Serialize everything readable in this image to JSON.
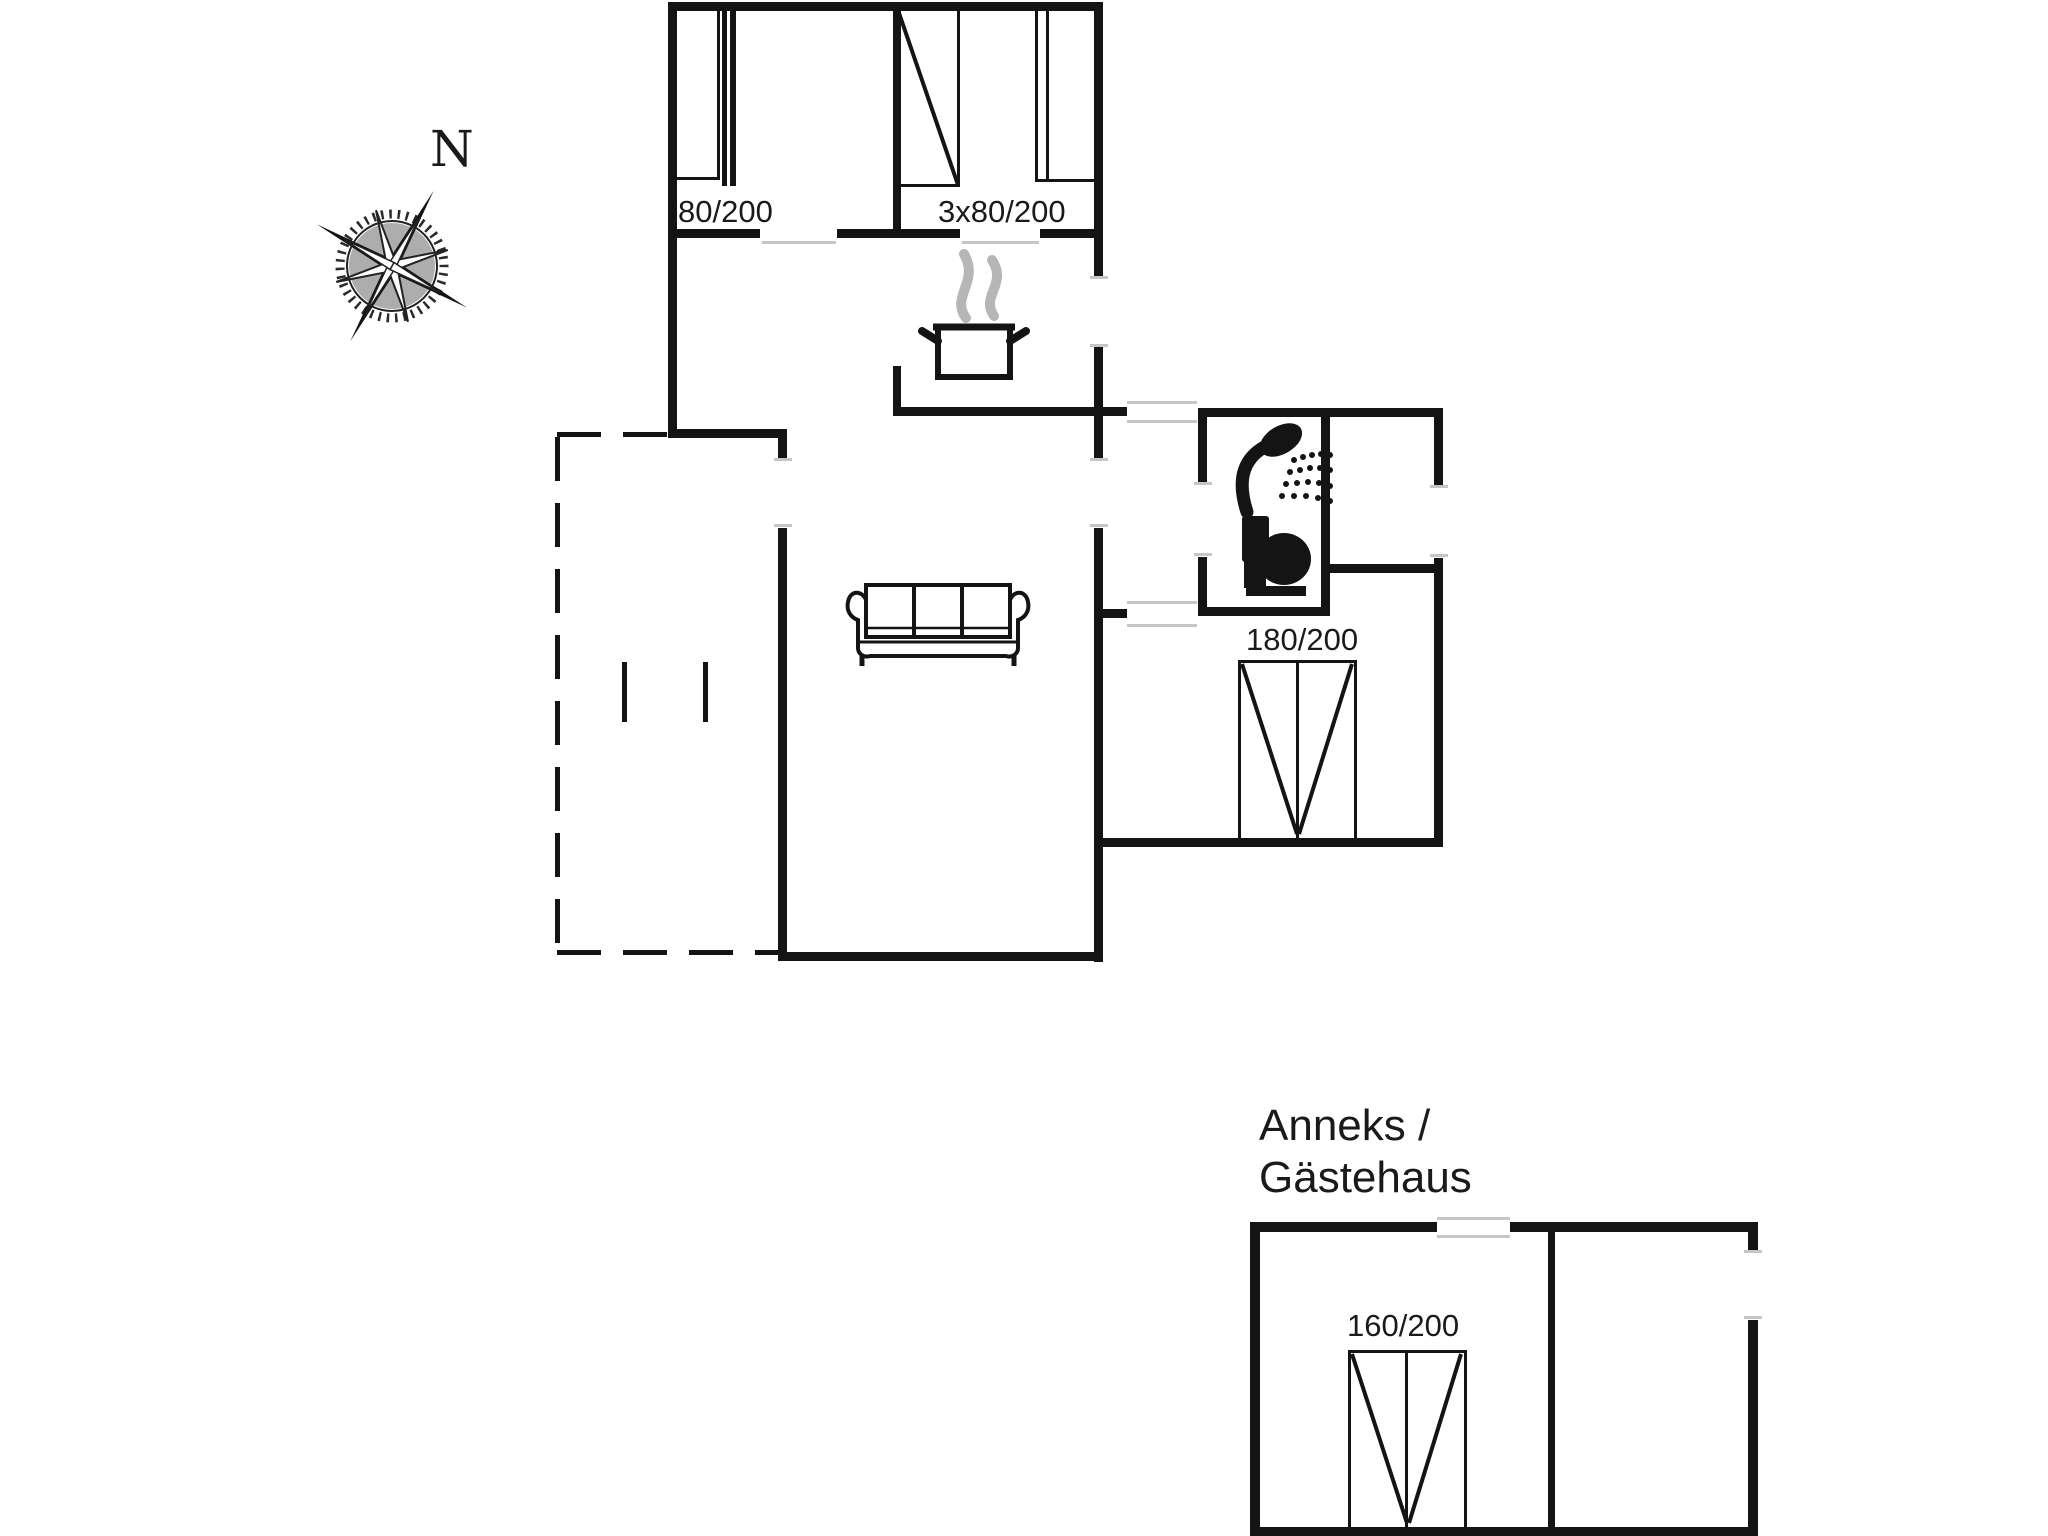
{
  "colors": {
    "wall": "#141414",
    "light": "#c6c6c6",
    "steam": "#b6b6b6",
    "text": "#1a1a1a",
    "bg": "#ffffff"
  },
  "compass": {
    "north_label": "N"
  },
  "labels": {
    "window_80": "80/200",
    "window_3x80": "3x80/200",
    "window_180": "180/200",
    "window_160": "160/200",
    "annex_line1": "Anneks /",
    "annex_line2": "Gästehaus"
  },
  "fixtures": {
    "compass": "compass-rose-icon",
    "stove": "cooking-pot-steam-icon",
    "shower": "shower-icon",
    "toilet": "toilet-icon",
    "sofa": "sofa-icon",
    "wardrobe_left": "wardrobe-sliding-doors",
    "wardrobe_right": "wardrobe",
    "terrace": "terrace-dashed-outline"
  }
}
